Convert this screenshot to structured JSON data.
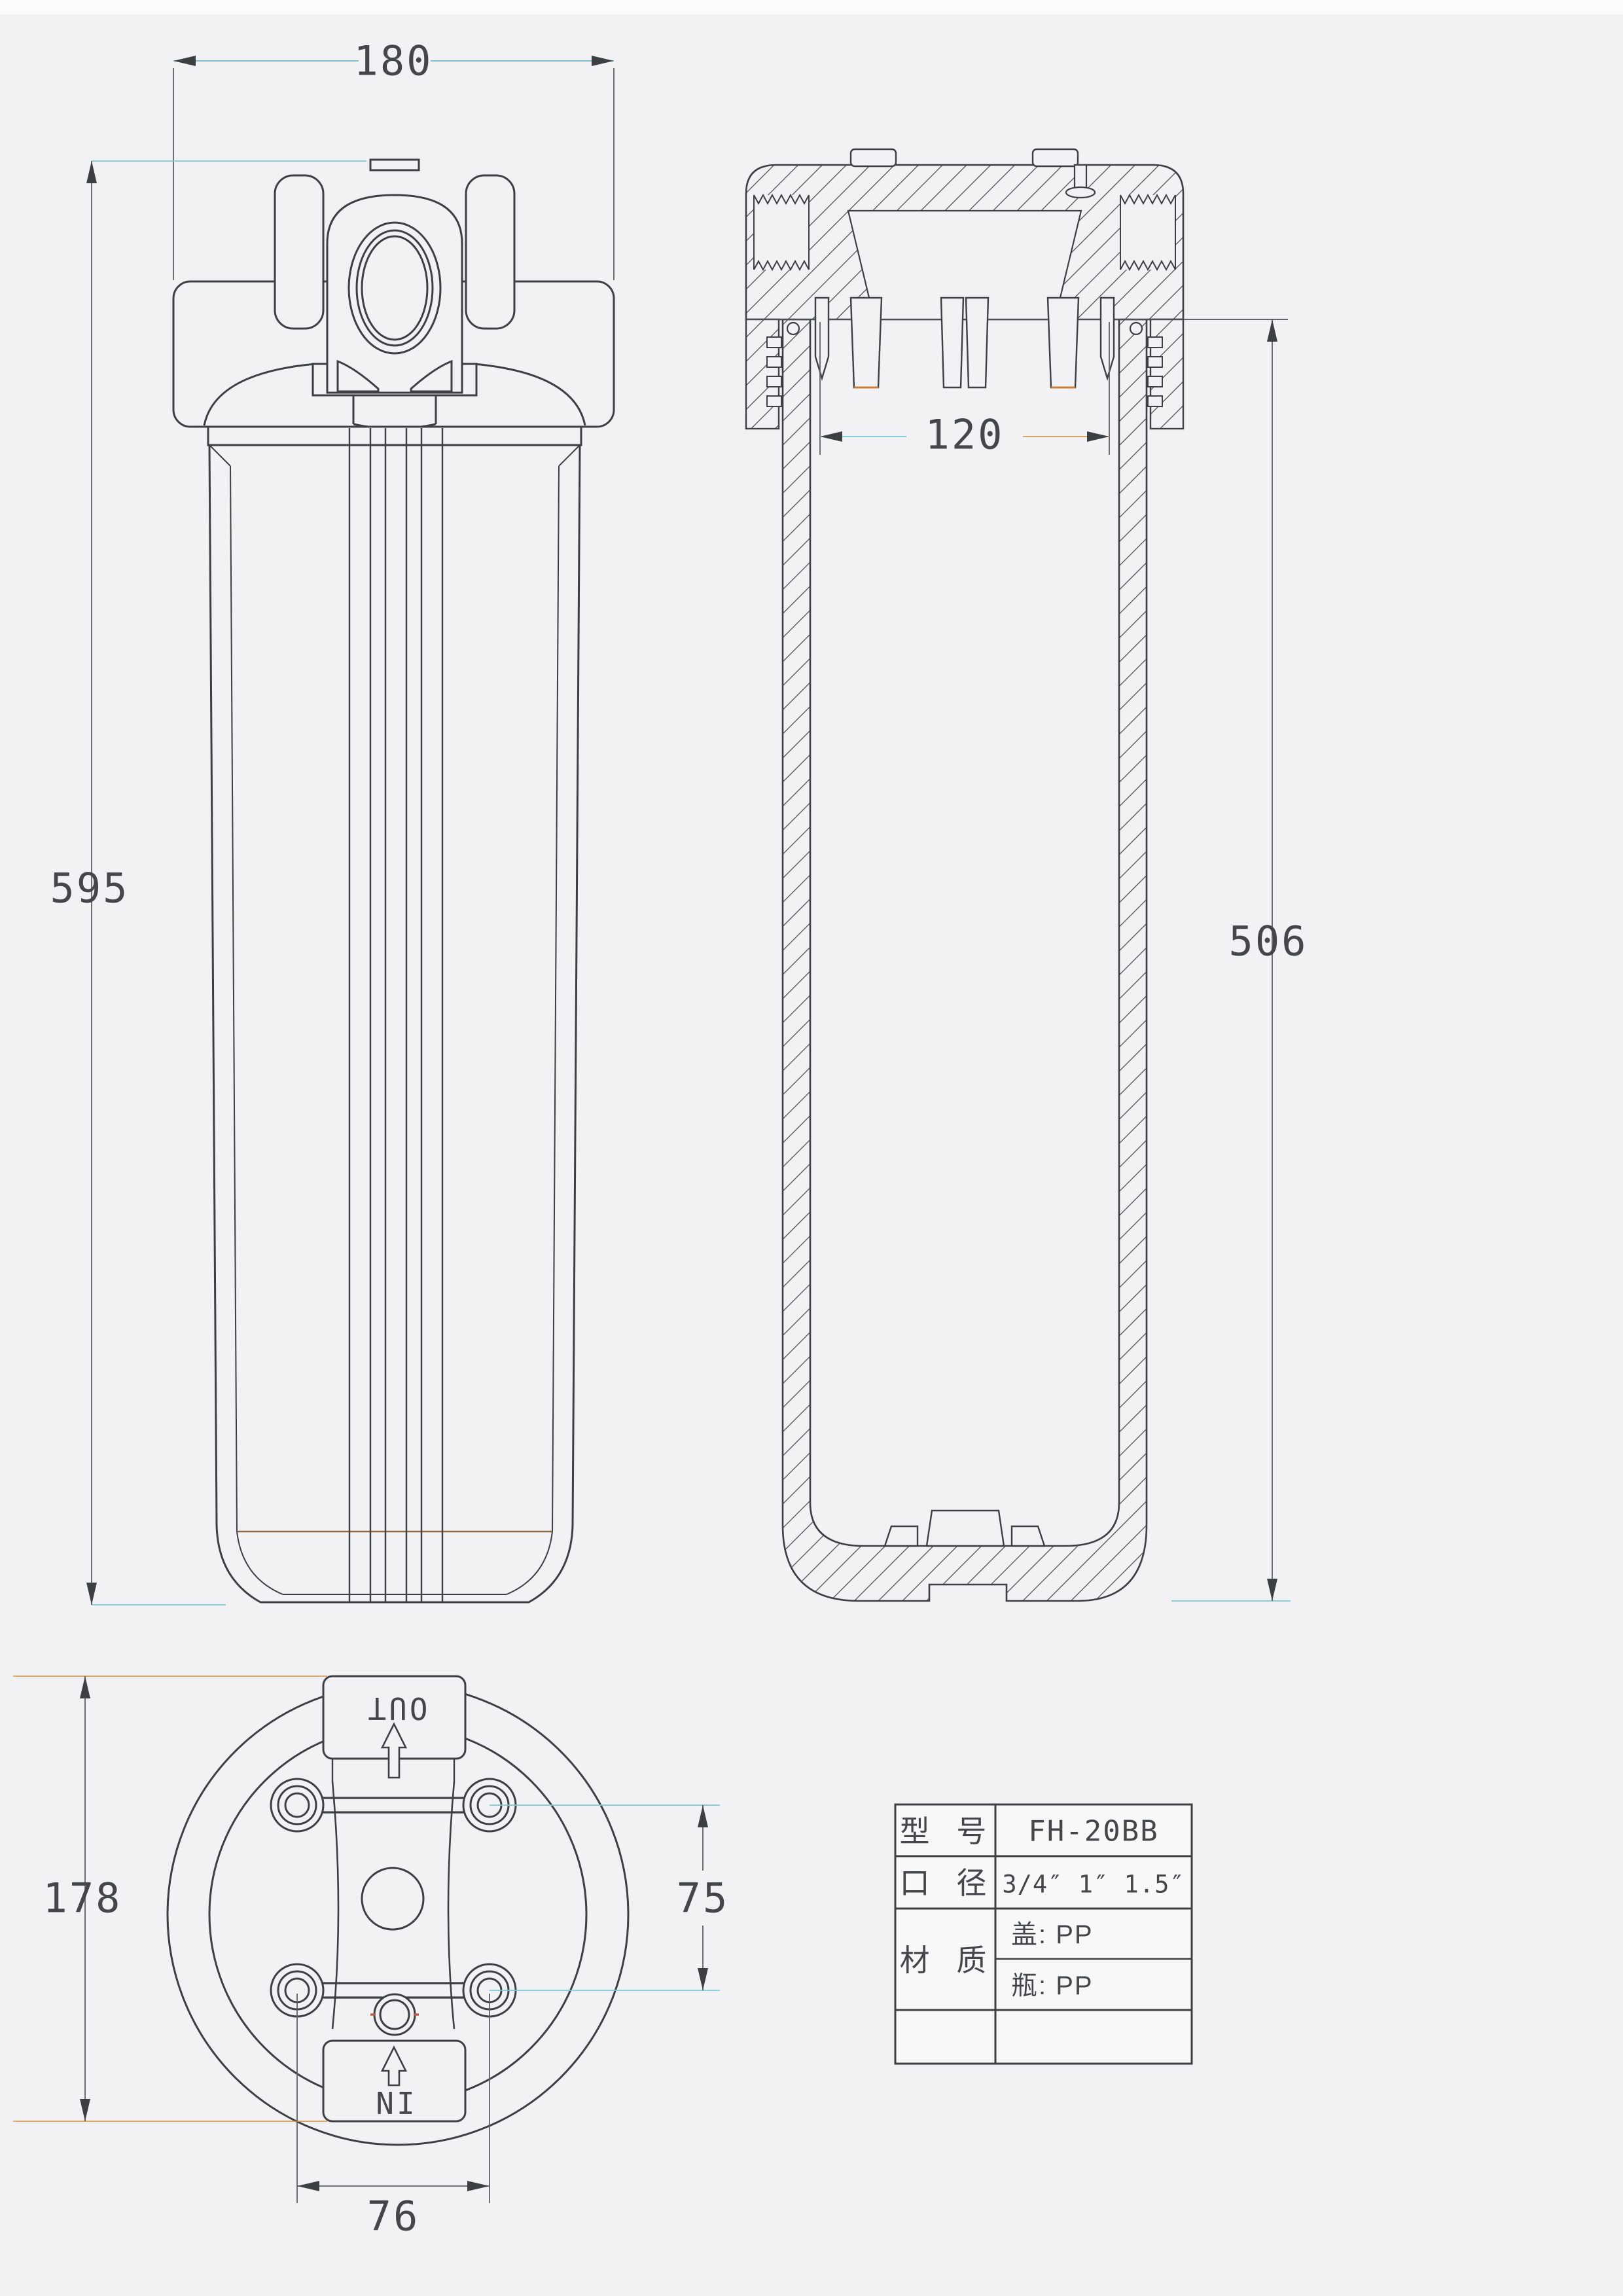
{
  "drawing": {
    "type": "engineering-drawing",
    "subject": "big blue water filter housing",
    "background": "#f2f1f4",
    "line_color": "#3d4043",
    "accent_cyan": "#79c9d8",
    "accent_orange": "#d79b55"
  },
  "dimensions": {
    "cap_width": "180",
    "overall_height": "595",
    "cavity_width": "120",
    "bottle_height": "506",
    "flange_height": "178",
    "port_offset_vertical": "75",
    "bolt_spacing": "76"
  },
  "port_labels": {
    "out": "OUT",
    "in": "IN"
  },
  "title_block": {
    "model_label": "型 号",
    "model_value": "FH-20BB",
    "caliber_label": "口 径",
    "caliber_value": "3/4″ 1″ 1.5″",
    "material_label": "材 质",
    "material_cap": "盖: PP",
    "material_bottle": "瓶: PP"
  }
}
